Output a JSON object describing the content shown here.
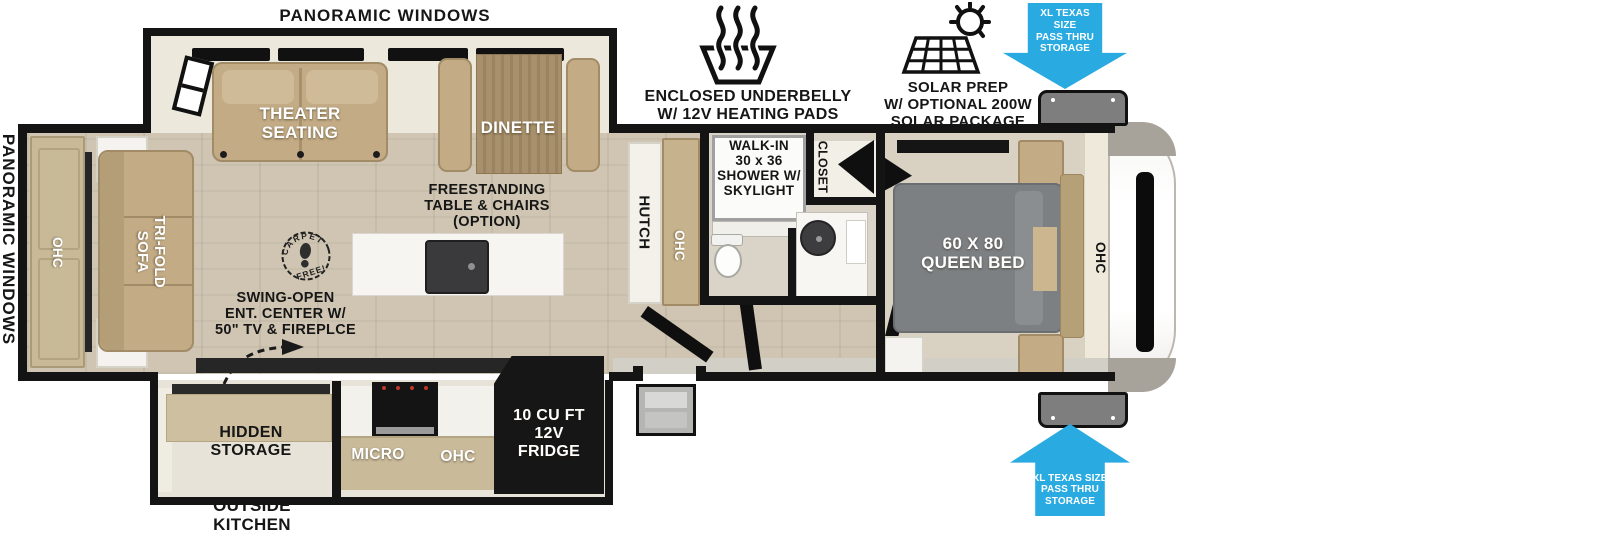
{
  "colors": {
    "wall": "#141414",
    "cyan": "#29abe2",
    "tan": "#c2ab85",
    "floor": "#cfc5b2",
    "bed": "#7d8083"
  },
  "callouts": {
    "panoramic_top": "PANORAMIC WINDOWS",
    "panoramic_left": "PANORAMIC WINDOWS",
    "underbelly": "ENCLOSED UNDERBELLY\nW/ 12V HEATING PADS",
    "solar": "SOLAR PREP\nW/ OPTIONAL 200W\nSOLAR PACKAGE",
    "pass_thru_front_top": "XL TEXAS SIZE\nPASS THRU\nSTORAGE",
    "pass_thru_front_bottom": "XL TEXAS SIZE\nPASS THRU\nSTORAGE",
    "outside_kitchen": "OUTSIDE\nKITCHEN"
  },
  "living_area": {
    "theater_seating": "THEATER\nSEATING",
    "dinette": "DINETTE",
    "freestanding_option": "FREESTANDING\nTABLE & CHAIRS\n(OPTION)",
    "tri_fold_sofa": "TRI-FOLD\nSOFA",
    "rear_ohc": "OHC",
    "ent_center": "SWING-OPEN\nENT. CENTER W/\n50\" TV & FIREPLCE",
    "carpet_stamp": {
      "arc_top": "CARPET",
      "arc_bottom": "FREE!"
    }
  },
  "kitchen": {
    "hutch": "HUTCH",
    "hutch_ohc": "OHC",
    "micro": "MICRO",
    "ohc": "OHC",
    "fridge": "10 CU FT\n12V\nFRIDGE",
    "hidden_storage": "HIDDEN\nSTORAGE"
  },
  "bathroom": {
    "shower": "WALK-IN\n30 x 36\nSHOWER W/\nSKYLIGHT",
    "closet": "CLOSET"
  },
  "bedroom": {
    "queen_bed": "60 X 80\nQUEEN BED",
    "ohc": "OHC"
  }
}
